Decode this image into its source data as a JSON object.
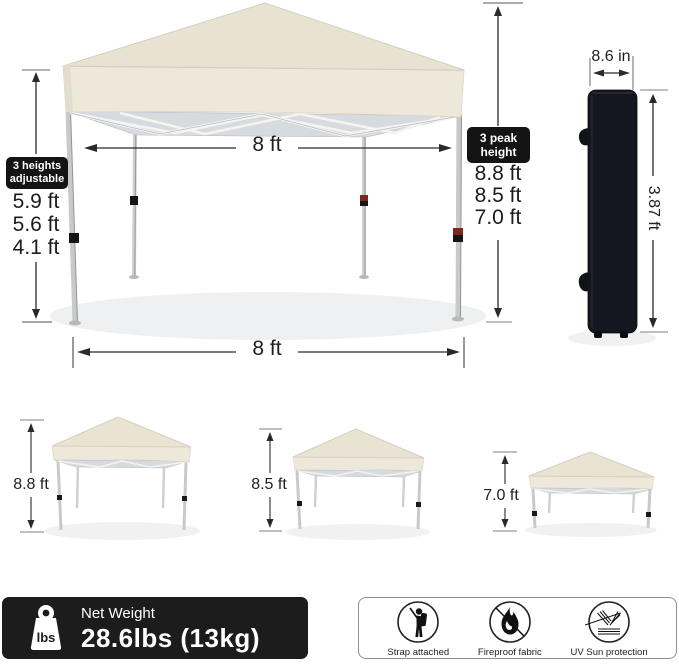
{
  "product": "pop-up canopy tent size diagram",
  "colors": {
    "canopy": "#e8e2d2",
    "valance": "#eee8da",
    "truss": "#d7dade",
    "bag": "#16161e",
    "label_bg": "#141414",
    "bar_bg": "#1c1c1c",
    "collar_red": "#7d2622"
  },
  "left_heights": {
    "label_line1": "3 heights",
    "label_line2": "adjustable",
    "values": [
      "5.9 ft",
      "5.6 ft",
      "4.1 ft"
    ]
  },
  "peak_heights": {
    "label_line1": "3 peak",
    "label_line2": "height",
    "values": [
      "8.8 ft",
      "8.5 ft",
      "7.0 ft"
    ]
  },
  "dimensions": {
    "width_top": "8 ft",
    "width_bottom": "8 ft",
    "bag_width": "8.6 in",
    "bag_height": "3.87 ft"
  },
  "small_tents": [
    {
      "height": "8.8 ft"
    },
    {
      "height": "8.5 ft"
    },
    {
      "height": "7.0 ft"
    }
  ],
  "weight": {
    "title": "Net Weight",
    "value": "28.6lbs (13kg)",
    "unit": "lbs"
  },
  "features": [
    {
      "icon": "strap-person-icon",
      "label": "Strap attached"
    },
    {
      "icon": "fireproof-flame-icon",
      "label": "Fireproof fabric"
    },
    {
      "icon": "uv-reflection-icon",
      "label": "UV Sun protection"
    }
  ]
}
